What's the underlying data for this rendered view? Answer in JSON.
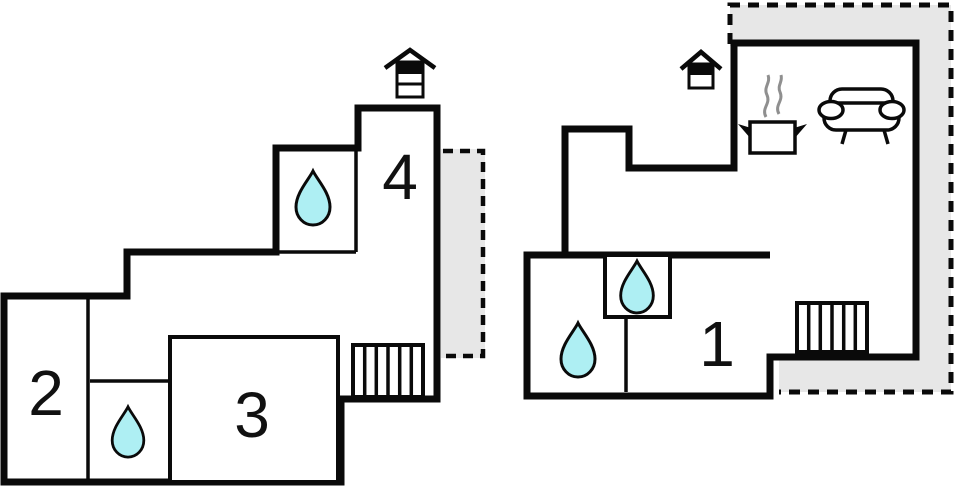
{
  "plan": {
    "rooms": {
      "room1": "1",
      "room2": "2",
      "room3": "3",
      "room4": "4"
    },
    "colors": {
      "wall": "#0a0a0a",
      "water": "#aeeff3",
      "terrace": "#e7e7e7",
      "steam": "#8f8f8f",
      "background": "#ffffff"
    },
    "icons": {
      "fireplace_chimney": "house-roof over rectangle with black top band",
      "water_drop": "teardrop shape (bath/shower)",
      "stairs": "rectangle with vertical stripes",
      "cooking_pot": "pot with side handles and steam (kitchen)",
      "sofa": "couch seen from front (living room)"
    }
  }
}
